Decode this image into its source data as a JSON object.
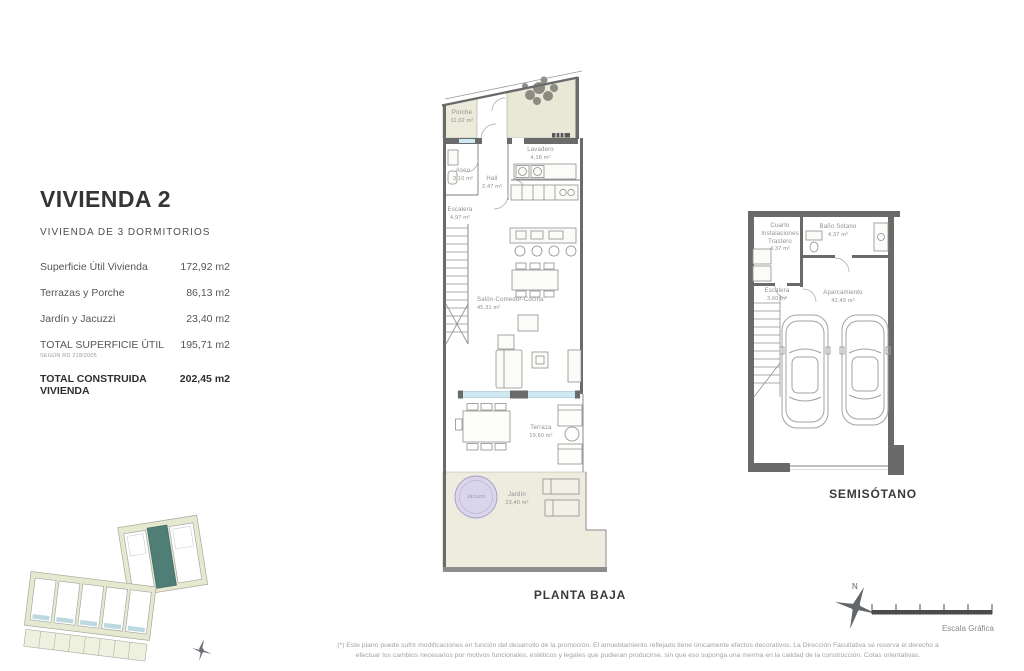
{
  "header": {
    "title": "VIVIENDA 2",
    "subtitle": "VIVIENDA DE 3 DORMITORIOS"
  },
  "info_table": {
    "rows": [
      {
        "label": "Superficie Útil Vivienda",
        "value": "172,92 m2"
      },
      {
        "label": "Terrazas y Porche",
        "value": "86,13 m2"
      },
      {
        "label": "Jardín y Jacuzzi",
        "value": "23,40 m2"
      },
      {
        "label": "TOTAL SUPERFICIE ÚTIL",
        "note": "SEGÚN RD 218/2005",
        "value": "195,71 m2"
      },
      {
        "label": "TOTAL CONSTRUIDA VIVIENDA",
        "value": "202,45 m2"
      }
    ]
  },
  "planta_baja": {
    "caption": "PLANTA BAJA",
    "rooms": {
      "porche": {
        "name": "Porche",
        "area": "11,02 m²"
      },
      "aseo": {
        "name": "Aseo",
        "area": "3,10 m²"
      },
      "hall": {
        "name": "Hall",
        "area": "2,47 m²"
      },
      "lavadero": {
        "name": "Lavadero",
        "area": "4,18 m²"
      },
      "escalera": {
        "name": "Escalera",
        "area": "4,97 m²"
      },
      "salon": {
        "name": "Salón-Comedor-Cocina",
        "area": "45,31 m²"
      },
      "terraza": {
        "name": "Terraza",
        "area": "19,60 m²"
      },
      "jardin": {
        "name": "Jardín",
        "area": "23,40 m²"
      },
      "jacuzzi": {
        "name": "Jacuzzi"
      }
    }
  },
  "semisotano": {
    "caption": "SEMISÓTANO",
    "rooms": {
      "cuarto_instalaciones": {
        "name": "Cuarto Instalaciones Trastero",
        "area": "4,37 m²"
      },
      "bano_sotano": {
        "name": "Baño Sótano",
        "area": "4,37 m²"
      },
      "escalera": {
        "name": "Escalera",
        "area": "3,60 m²"
      },
      "aparcamiento": {
        "name": "Aparcamiento",
        "area": "42,49 m²"
      }
    }
  },
  "footer": {
    "north_label": "N",
    "scale_label": "Escala Gráfica",
    "disclaimer_line1": "(*) Este plano puede sufrir modificaciones en función del desarrollo de la promoción. El amueblamiento reflejado tiene únicamente efectos decorativos. La Dirección Facultativa se reserva el derecho a",
    "disclaimer_line2": "efectuar los cambios necesarios por motivos funcionales, estéticos y legales que pudieran producirse, sin que eso suponga una merma en la calidad de la construcción. Cotas orientativas."
  },
  "colors": {
    "wall_gray": "#6a6a6a",
    "outdoor_beige": "#ebeadb",
    "glass_blue": "#cfe9f2",
    "jacuzzi_lavender": "#d9d6ec",
    "site_highlight_teal": "#4e7e76"
  }
}
